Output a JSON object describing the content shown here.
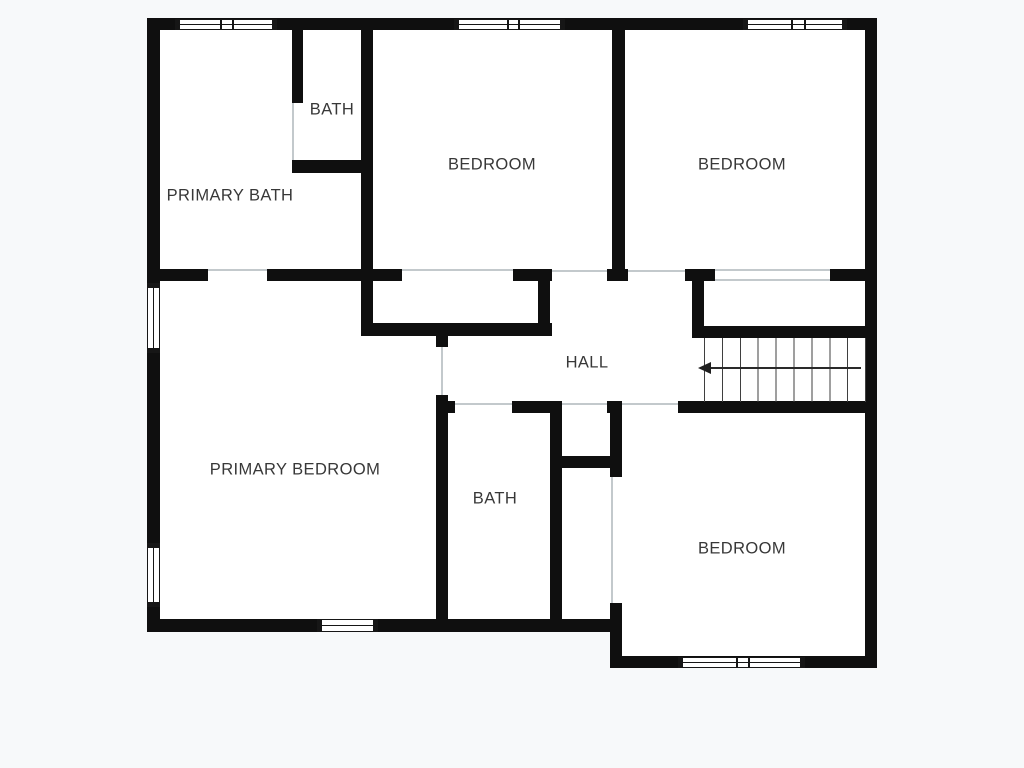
{
  "floor_plan": {
    "rooms": [
      {
        "id": "bath-upper",
        "label": "BATH"
      },
      {
        "id": "primary-bath",
        "label": "PRIMARY BATH"
      },
      {
        "id": "bedroom-top-middle",
        "label": "BEDROOM"
      },
      {
        "id": "bedroom-top-right",
        "label": "BEDROOM"
      },
      {
        "id": "hall",
        "label": "HALL"
      },
      {
        "id": "primary-bedroom",
        "label": "PRIMARY BEDROOM"
      },
      {
        "id": "bath-lower",
        "label": "BATH"
      },
      {
        "id": "bedroom-bottom-right",
        "label": "BEDROOM"
      }
    ],
    "stairs": {
      "arrow_direction": "left",
      "tread_count": 10
    },
    "colors": {
      "background": "#f7f9fa",
      "room_fill": "#ffffff",
      "wall": "#0f0f0f",
      "label_text": "#383838",
      "opening_line": "#c3c9cc",
      "tread_line": "#3f3f3f"
    }
  }
}
